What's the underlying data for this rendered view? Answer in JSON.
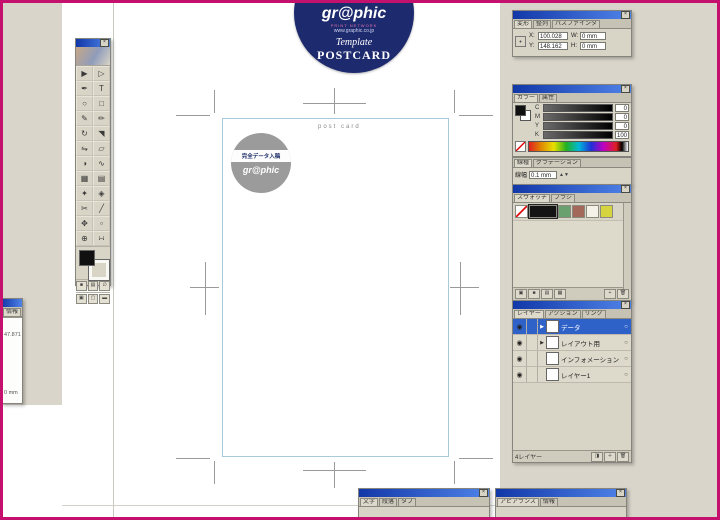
{
  "window": {
    "border_color": "#c4116e"
  },
  "badge": {
    "brand": "gr@phic",
    "tagline": "PRINT NETWORK",
    "url": "www.graphic.co.jp",
    "template_label": "Template",
    "product_label": "POSTCARD"
  },
  "canvas": {
    "postcard_label": "post card",
    "logo_band_text": "完全データ入稿",
    "logo_brand": "gr@phic"
  },
  "toolbar": {
    "tools": [
      {
        "name": "selection",
        "glyph": "▶"
      },
      {
        "name": "direct-selection",
        "glyph": "▷"
      },
      {
        "name": "pen",
        "glyph": "✒"
      },
      {
        "name": "type",
        "glyph": "T"
      },
      {
        "name": "ellipse",
        "glyph": "○"
      },
      {
        "name": "rectangle",
        "glyph": "□"
      },
      {
        "name": "pencil",
        "glyph": "✎"
      },
      {
        "name": "paintbrush",
        "glyph": "✏"
      },
      {
        "name": "rotate",
        "glyph": "↻"
      },
      {
        "name": "scale",
        "glyph": "◥"
      },
      {
        "name": "reflect",
        "glyph": "⇋"
      },
      {
        "name": "shear",
        "glyph": "▱"
      },
      {
        "name": "blend",
        "glyph": "◑"
      },
      {
        "name": "autotrace",
        "glyph": "∿"
      },
      {
        "name": "graph",
        "glyph": "▦"
      },
      {
        "name": "gradient",
        "glyph": "▤"
      },
      {
        "name": "eyedropper",
        "glyph": "✦"
      },
      {
        "name": "paint-bucket",
        "glyph": "◈"
      },
      {
        "name": "scissors",
        "glyph": "✂"
      },
      {
        "name": "knife",
        "glyph": "╱"
      },
      {
        "name": "hand",
        "glyph": "✥"
      },
      {
        "name": "page",
        "glyph": "▫"
      },
      {
        "name": "zoom",
        "glyph": "⊕"
      },
      {
        "name": "measure",
        "glyph": "∺"
      }
    ]
  },
  "palettes": {
    "transform": {
      "tabs": [
        "変形",
        "整列",
        "パスファインダ"
      ],
      "x_label": "X:",
      "x_value": "100.028",
      "y_label": "Y:",
      "y_value": "148.162",
      "w_label": "W:",
      "w_value": "0 mm",
      "h_label": "H:",
      "h_value": "0 mm"
    },
    "color": {
      "tabs": [
        "カラー",
        "属性"
      ],
      "channels": [
        {
          "label": "C",
          "value": "0"
        },
        {
          "label": "M",
          "value": "0"
        },
        {
          "label": "Y",
          "value": "0"
        },
        {
          "label": "K",
          "value": "100"
        }
      ]
    },
    "stroke": {
      "tabs": [
        "線種",
        "グラデーション"
      ],
      "weight_label": "線幅",
      "weight_value": "0.1 mm"
    },
    "swatches": {
      "tabs": [
        "スウォッチ",
        "ブラシ"
      ],
      "items": [
        {
          "name": "none",
          "css": "#ffffff",
          "none": true
        },
        {
          "name": "black",
          "css": "#141414",
          "wide": true
        },
        {
          "name": "green",
          "css": "#69a06e"
        },
        {
          "name": "brown",
          "css": "#a3685a"
        },
        {
          "name": "white",
          "css": "#f4f1e8"
        },
        {
          "name": "yellow",
          "css": "#d6d43e"
        }
      ]
    },
    "layers": {
      "tabs": [
        "レイヤー",
        "アクション",
        "リンク"
      ],
      "rows": [
        {
          "name": "データ",
          "selected": true,
          "expandable": true
        },
        {
          "name": "レイアウト用",
          "selected": false,
          "expandable": true
        },
        {
          "name": "インフォメーション",
          "selected": false,
          "expandable": false
        },
        {
          "name": "レイヤー1",
          "selected": false,
          "expandable": false
        }
      ],
      "status": "4レイヤー"
    },
    "character": {
      "tabs": [
        "文字",
        "段落",
        "タブ"
      ]
    },
    "appearance": {
      "tabs": [
        "アピアランス",
        "情報"
      ]
    },
    "info": {
      "tab": "情報",
      "line1": "47.871",
      "line2": "0 mm"
    }
  }
}
